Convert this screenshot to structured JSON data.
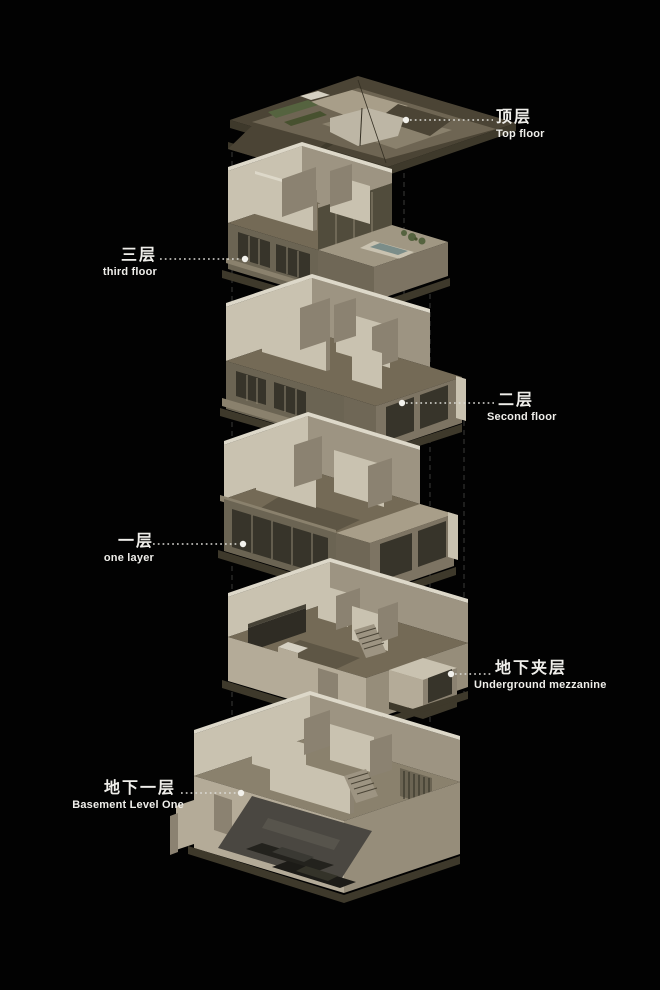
{
  "page": {
    "background": "#000000",
    "width": 660,
    "height": 990
  },
  "floors": [
    {
      "id": "top-floor",
      "label_zh": "顶层",
      "label_en": "Top floor",
      "label_side": "right",
      "illustration": "roof-axonometric"
    },
    {
      "id": "third-floor",
      "label_zh": "三层",
      "label_en": "third floor",
      "label_side": "left",
      "illustration": "third-floor-cutaway-with-terrace-pool"
    },
    {
      "id": "second-floor",
      "label_zh": "二层",
      "label_en": "Second floor",
      "label_side": "right",
      "illustration": "second-floor-cutaway"
    },
    {
      "id": "first-floor",
      "label_zh": "一层",
      "label_en": "one layer",
      "label_side": "left",
      "illustration": "first-floor-cutaway"
    },
    {
      "id": "underground-mezzanine",
      "label_zh": "地下夹层",
      "label_en": "Underground mezzanine",
      "label_side": "right",
      "illustration": "mezzanine-open-plan"
    },
    {
      "id": "basement-level-one",
      "label_zh": "地下一层",
      "label_en": "Basement Level One",
      "label_side": "left",
      "illustration": "basement-plan-with-garage-cars"
    }
  ],
  "palette": {
    "background": "#000000",
    "label_text": "#efeeea",
    "leader_line": "#dcdbd6",
    "guide_line": "#3a3a38",
    "wall_light": "#c9c2b0",
    "wall_shadow": "#8b8271",
    "facade_dark": "#6b6453",
    "window_glass": "#37342a",
    "floor_brown": "#746a56",
    "roof_dark": "#4b4435",
    "roof_light": "#a89e89",
    "vegetation": "#55633f",
    "pool_water": "#7b8d89",
    "garage_floor": "#4a4741",
    "car_body": "#23221d"
  }
}
